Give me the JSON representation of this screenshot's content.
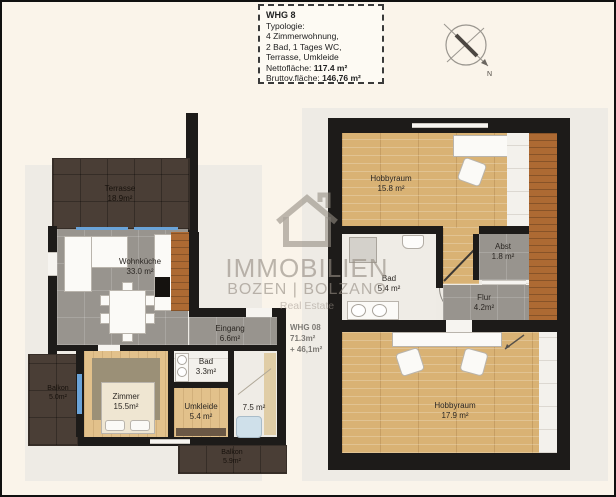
{
  "info_box": {
    "title": "WHG 8",
    "lines": [
      "Typologie:",
      "4 Zimmerwohnung,",
      "2 Bad, 1 Tages WC,",
      "Terrasse, Umkleide"
    ],
    "netto_label": "Nettofläche:",
    "netto_value": "117.4 m²",
    "brutto_label": "Bruttov.fläche:",
    "brutto_value": "146,76 m²"
  },
  "compass": {
    "north_label": "N"
  },
  "annotation": {
    "line1": "WHG 08",
    "line2": "71.3m²",
    "line3": "+ 46,1m²"
  },
  "watermark": {
    "line1": "IMMOBILIEN",
    "line2": "BOZEN | BOLZANO",
    "line3": "Real Estate"
  },
  "floor1": {
    "terrasse": {
      "name": "Terrasse",
      "area": "18.9m²"
    },
    "wohnkueche": {
      "name": "Wohnküche",
      "area": "33.0 m²"
    },
    "eingang": {
      "name": "Eingang",
      "area": "6.6m²"
    },
    "bad": {
      "name": "Bad",
      "area": "3.3m²"
    },
    "zimmer": {
      "name": "Zimmer",
      "area": "15.5m²"
    },
    "umkleide": {
      "name": "Umkleide",
      "area": "5.4 m²"
    },
    "room75": {
      "area": "7.5 m²"
    },
    "balkon_left": {
      "name": "Balkon",
      "area": "5.0m²"
    },
    "balkon_bottom": {
      "name": "Balkon",
      "area": "5.9m²"
    }
  },
  "floor2": {
    "hobbyraum1": {
      "name": "Hobbyraum",
      "area": "15.8 m²"
    },
    "bad": {
      "name": "Bad",
      "area": "5.4 m²"
    },
    "abst": {
      "name": "Abst",
      "area": "1.8 m²"
    },
    "flur": {
      "name": "Flur",
      "area": "4.2m²"
    },
    "hobbyraum2": {
      "name": "Hobbyraum",
      "area": "17.9 m²"
    }
  },
  "colors": {
    "background_cream": "#faf4ea",
    "backdrop_gray": "#eeebe5",
    "wall_black": "#1d1b19",
    "terrace_brown": "#4a3e36",
    "floor_gray_tile": "#98948e",
    "wood_light": "#d9b274",
    "wood_orange": "#ad6a33",
    "window_blue": "#6aa3d8"
  }
}
